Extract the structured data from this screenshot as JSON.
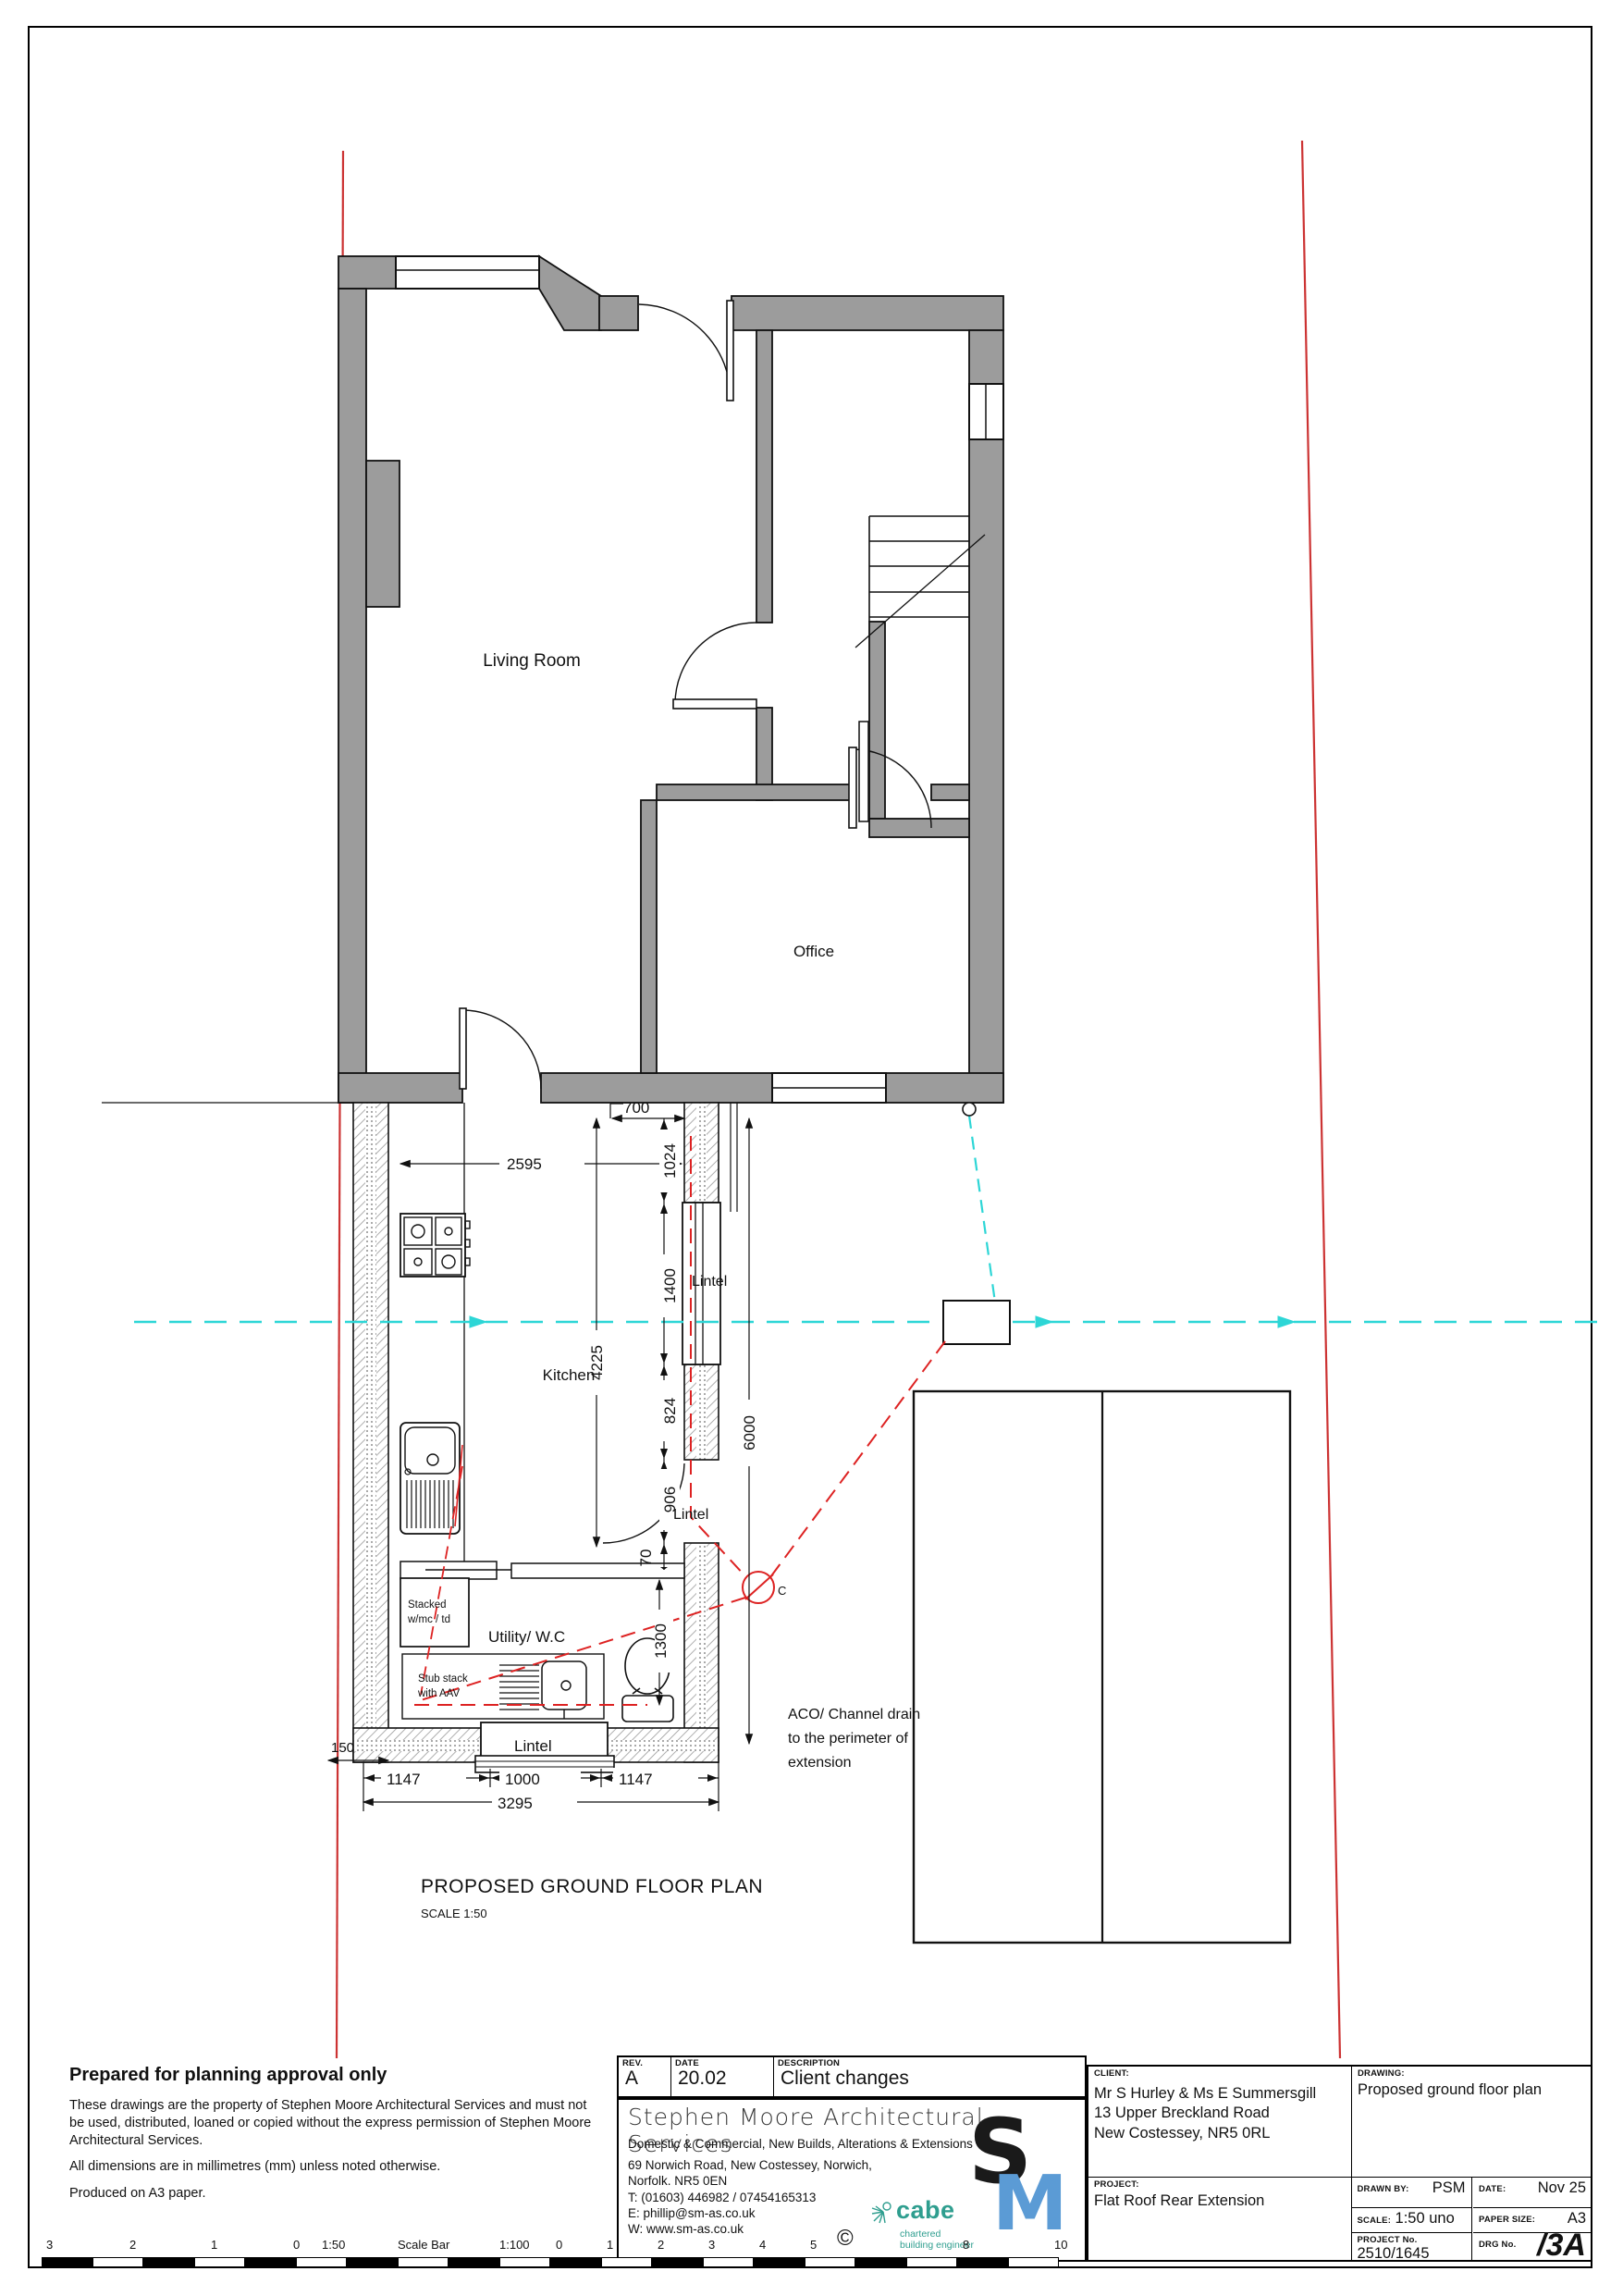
{
  "plan": {
    "labels": {
      "living_room": "Living Room",
      "office": "Office",
      "kitchen": "Kitchen",
      "utility": "Utility/ W.C",
      "lintel": "Lintel",
      "stacked1": "Stacked",
      "stacked2": "w/mc / td",
      "stub1": "Stub stack",
      "stub2": "with AAV",
      "aco1": "ACO/ Channel drain",
      "aco2": "to the perimeter of",
      "aco3": "extension",
      "chamber": "C",
      "title": "PROPOSED GROUND FLOOR PLAN",
      "scale": "SCALE 1:50"
    },
    "dims": {
      "w2595": "2595",
      "o700": "700",
      "v1024": "1024",
      "v1400": "1400",
      "v824": "824",
      "v906": "906",
      "v70": "70",
      "v4225": "4225",
      "v6000": "6000",
      "v1300": "1300",
      "v150": "150",
      "b1147a": "1147",
      "b1000": "1000",
      "b1147b": "1147",
      "b3295": "3295"
    },
    "colors": {
      "wall_gray": "#9c9c9c",
      "boundary_red": "#cc3333",
      "drain_red": "#dd2222",
      "service_cyan": "#2dd6d6",
      "sm_blue": "#5b9bd5",
      "cabe_teal": "#2f9e8f"
    }
  },
  "notes": {
    "title": "Prepared for planning approval only",
    "p1": "These drawings are the property of Stephen Moore Architectural Services and must not be used, distributed, loaned or copied without the express permission of Stephen Moore Architectural Services.",
    "p2": "All dimensions are in millimetres (mm) unless noted otherwise.",
    "p3": "Produced on A3 paper."
  },
  "revision": {
    "rev_label": "REV.",
    "rev": "A",
    "date_label": "DATE",
    "date": "20.02",
    "desc_label": "DESCRIPTION",
    "desc": "Client changes"
  },
  "company": {
    "name": "Stephen Moore Architectural Services",
    "tagline": "Domestic & Commercial, New Builds, Alterations & Extensions",
    "address1": "69 Norwich Road, New Costessey, Norwich,",
    "address2": "Norfolk. NR5 0EN",
    "tel": "T: (01603) 446982  / 07454165313",
    "email": "E: phillip@sm-as.co.uk",
    "web": "W: www.sm-as.co.uk"
  },
  "logos": {
    "sm_s": "S",
    "sm_m": "M",
    "cabe": "cabe",
    "cabe_sub1": "chartered",
    "cabe_sub2": "building engineer",
    "copyright": "©"
  },
  "titleblock": {
    "client_label": "CLIENT:",
    "client_line1": "Mr S Hurley & Ms E Summersgill",
    "client_line2": "13 Upper Breckland Road",
    "client_line3": "New Costessey, NR5 0RL",
    "drawing_label": "DRAWING:",
    "drawing": "Proposed ground floor plan",
    "project_label": "PROJECT:",
    "project": "Flat Roof Rear Extension",
    "drawn_by_label": "DRAWN BY:",
    "drawn_by": "PSM",
    "date_label": "DATE:",
    "date": "Nov 25",
    "scale_label": "SCALE:",
    "scale": "1:50 uno",
    "paper_label": "PAPER SIZE:",
    "paper": "A3",
    "project_no_label": "PROJECT No.",
    "project_no": "2510/1645",
    "drg_label": "DRG No.",
    "drg_no": "/3A"
  },
  "scalebar": {
    "numbers": [
      "3",
      "2",
      "1",
      "0",
      "1:50",
      "Scale Bar",
      "1:100",
      "0",
      "1",
      "2",
      "3",
      "4",
      "5",
      "8",
      "10"
    ]
  }
}
